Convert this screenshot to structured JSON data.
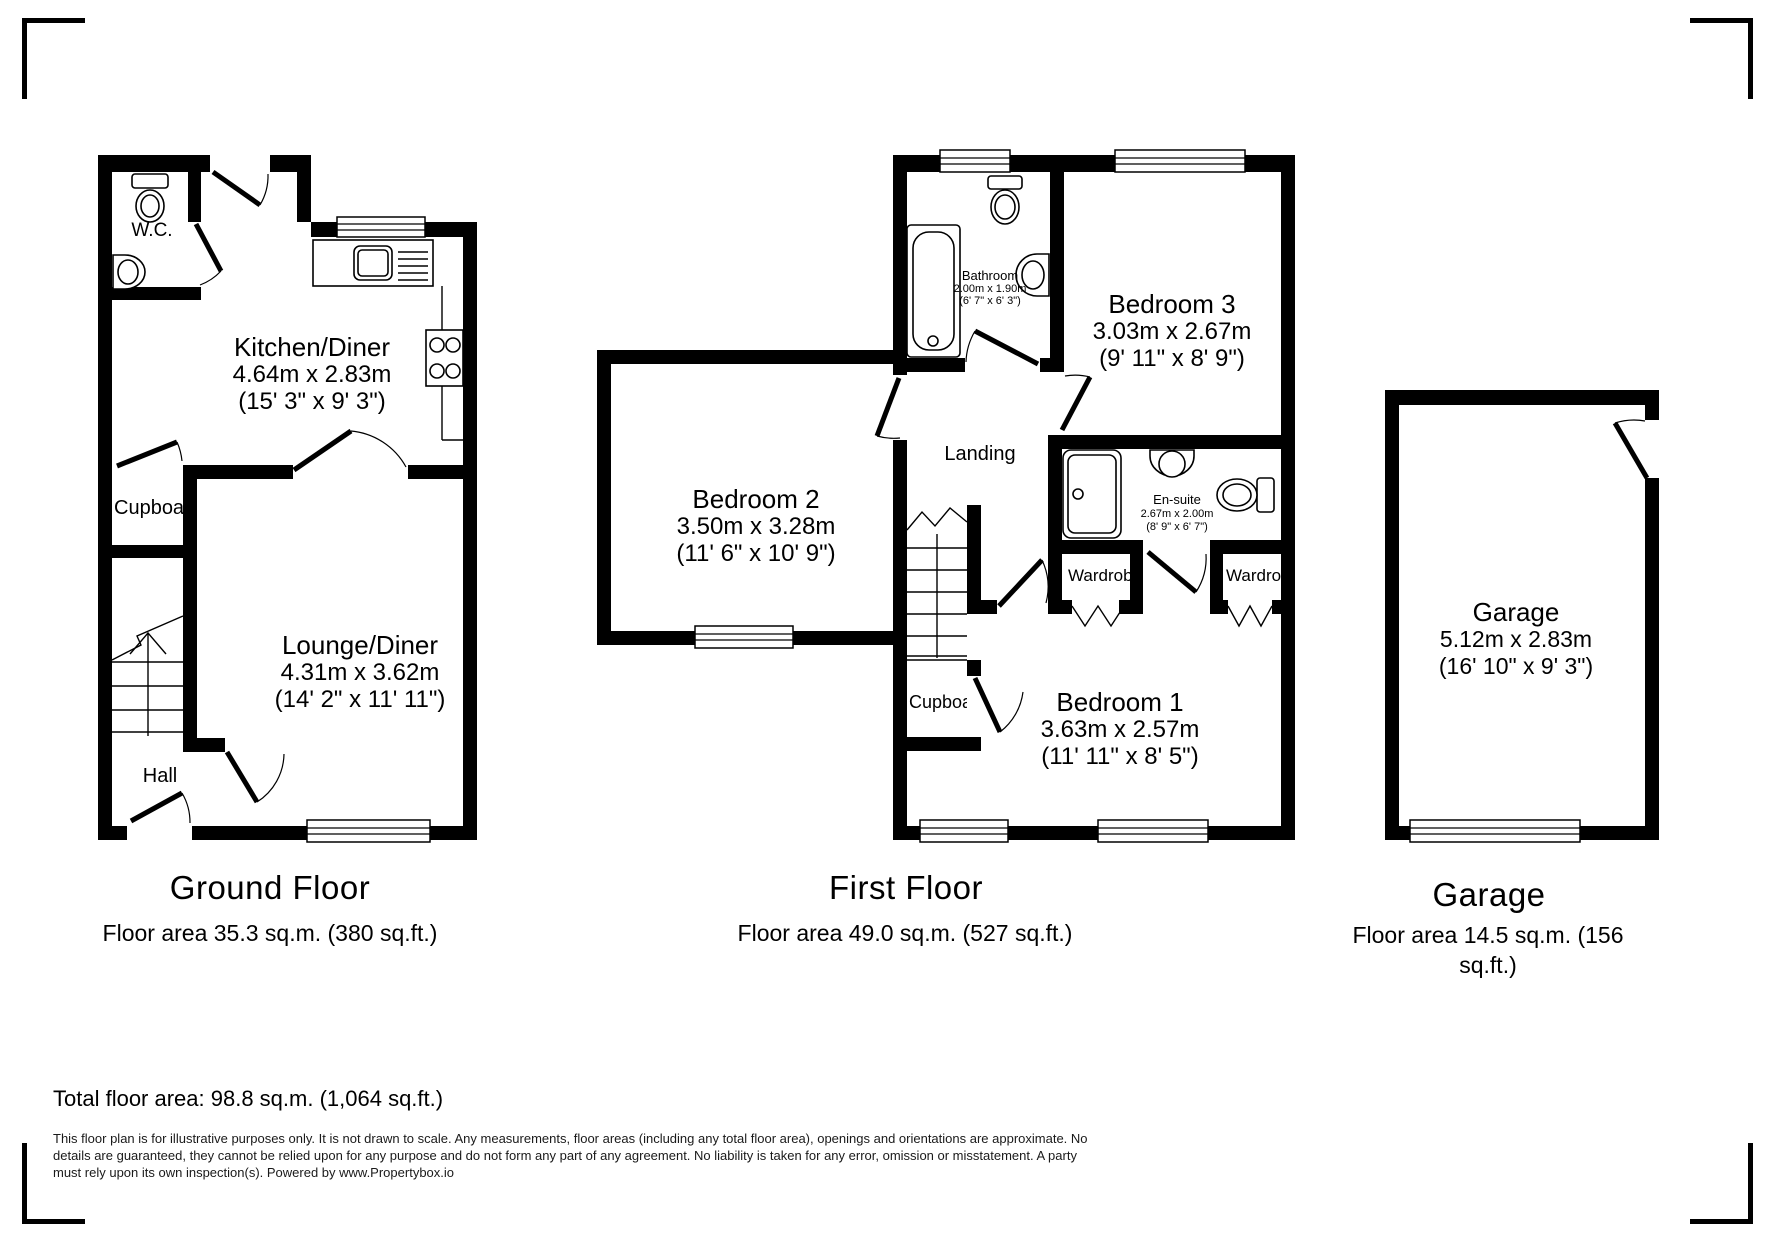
{
  "floors": {
    "ground": {
      "title": "Ground Floor",
      "area": "Floor area 35.3 sq.m. (380 sq.ft.)",
      "rooms": {
        "wc": {
          "name": "W.C."
        },
        "kitchen": {
          "name": "Kitchen/Diner",
          "dims_m": "4.64m x 2.83m",
          "dims_ft": "(15' 3\" x 9' 3\")"
        },
        "cupboard": {
          "name": "Cupboard"
        },
        "lounge": {
          "name": "Lounge/Diner",
          "dims_m": "4.31m x 3.62m",
          "dims_ft": "(14' 2\" x 11' 11\")"
        },
        "hall": {
          "name": "Hall"
        }
      }
    },
    "first": {
      "title": "First Floor",
      "area": "Floor area 49.0 sq.m. (527 sq.ft.)",
      "rooms": {
        "bathroom": {
          "name": "Bathroom",
          "dims_m": "2.00m x 1.90m",
          "dims_ft": "(6' 7\" x 6' 3\")"
        },
        "bedroom3": {
          "name": "Bedroom 3",
          "dims_m": "3.03m x 2.67m",
          "dims_ft": "(9' 11\" x 8' 9\")"
        },
        "bedroom2": {
          "name": "Bedroom 2",
          "dims_m": "3.50m x 3.28m",
          "dims_ft": "(11' 6\" x 10' 9\")"
        },
        "landing": {
          "name": "Landing"
        },
        "ensuite": {
          "name": "En-suite",
          "dims_m": "2.67m x 2.00m",
          "dims_ft": "(8' 9\" x 6' 7\")"
        },
        "wardrobe_left": {
          "name": "Wardrobe"
        },
        "wardrobe_right": {
          "name": "Wardrobe"
        },
        "cupboard": {
          "name": "Cupboard"
        },
        "bedroom1": {
          "name": "Bedroom 1",
          "dims_m": "3.63m x 2.57m",
          "dims_ft": "(11' 11\" x 8' 5\")"
        }
      }
    },
    "garage": {
      "title": "Garage",
      "area": "Floor area 14.5 sq.m. (156 sq.ft.)",
      "rooms": {
        "garage": {
          "name": "Garage",
          "dims_m": "5.12m x 2.83m",
          "dims_ft": "(16' 10\" x 9' 3\")"
        }
      }
    }
  },
  "footer": {
    "total": "Total floor area: 98.8 sq.m. (1,064 sq.ft.)",
    "disclaimer": "This floor plan is for illustrative purposes only. It is not drawn to scale. Any measurements, floor areas (including any total floor area), openings and orientations are approximate. No details are guaranteed, they cannot be relied upon for any purpose and do not form any part of any agreement. No liability is taken for any error, omission or misstatement. A party must rely upon its own inspection(s). Powered by www.Propertybox.io"
  },
  "colors": {
    "wall": "#000000",
    "background": "#ffffff"
  }
}
